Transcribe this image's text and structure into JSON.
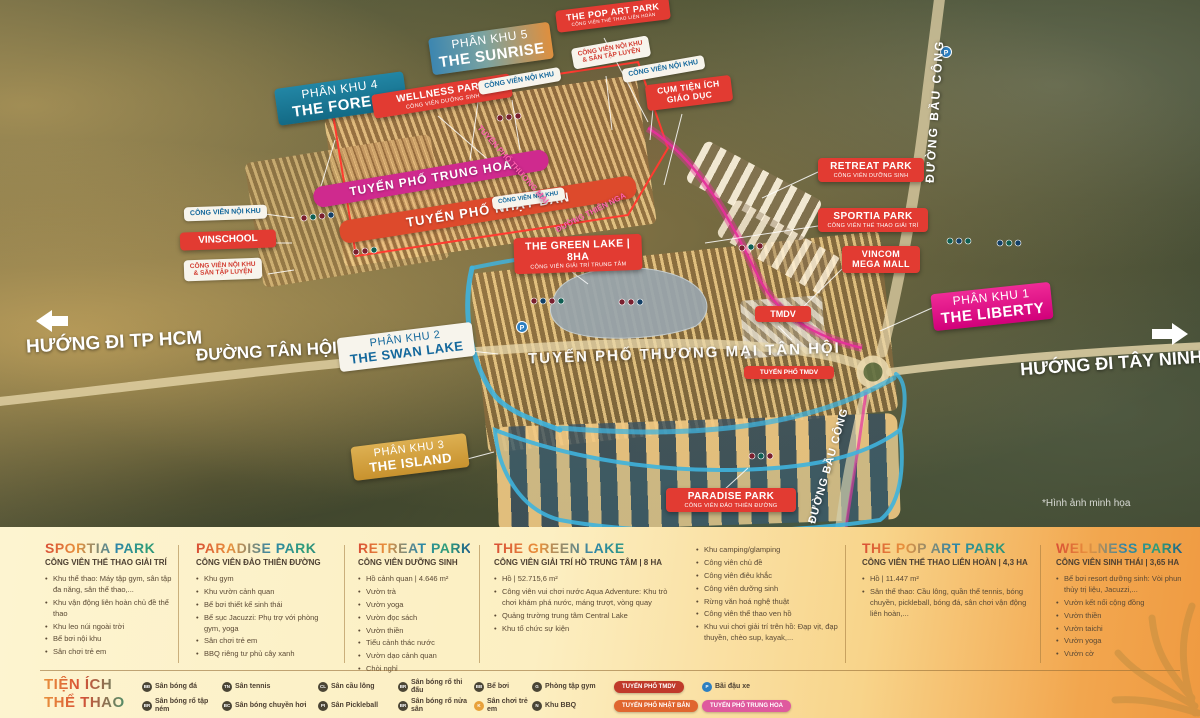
{
  "map": {
    "labels": {
      "phan_khu_4": {
        "line1": "PHÂN KHU 4",
        "line2": "THE FOREST"
      },
      "phan_khu_5": {
        "line1": "PHÂN KHU 5",
        "line2": "THE SUNRISE"
      },
      "phan_khu_1": {
        "line1": "PHÂN KHU 1",
        "line2": "THE LIBERTY"
      },
      "phan_khu_2": {
        "line1": "PHÂN KHU 2",
        "line2": "THE SWAN LAKE"
      },
      "phan_khu_3": {
        "line1": "PHÂN KHU 3",
        "line2": "THE ISLAND"
      },
      "wellness_park": {
        "line1": "WELLNESS PARK",
        "line2": "CÔNG VIÊN DƯỠNG SINH"
      },
      "pop_art_park": {
        "line1": "THE POP ART PARK",
        "line2": "CÔNG VIÊN THỂ THAO LIÊN HOÀN"
      },
      "retreat_park": {
        "line1": "RETREAT PARK",
        "line2": "CÔNG VIÊN DƯỠNG SINH"
      },
      "sportia_park": {
        "line1": "SPORTIA PARK",
        "line2": "CÔNG VIÊN THỂ THAO GIẢI TRÍ"
      },
      "vincom": {
        "line1": "VINCOM",
        "line2": "MEGA MALL"
      },
      "green_lake": {
        "line1": "THE GREEN LAKE | 8HA",
        "line2": "CÔNG VIÊN GIẢI TRÍ TRUNG TÂM"
      },
      "paradise_park": {
        "line1": "PARADISE PARK",
        "line2": "CÔNG VIÊN ĐẢO THIÊN ĐƯỜNG"
      },
      "cum_tien_ich": {
        "line1": "CỤM TIỆN ÍCH",
        "line2": "GIÁO DỤC"
      },
      "vinschool": "VINSCHOOL",
      "cv_noi_khu": "CÔNG VIÊN NỘI KHU",
      "san_tap_luyen": "& SÂN TẬP LUYỆN",
      "tmdv": "TMDV",
      "tuyen_pho_tmdv": "TUYẾN PHỐ TMDV",
      "tuyen_pho_trung_hoa": "TUYẾN PHỐ TRUNG HOA",
      "tuyen_pho_nhat_ban": "TUYẾN PHỐ NHẬT BẢN",
      "tuyen_pho_thuong_mai": "TUYẾN PHỐ THƯƠNG MẠI TÂN HỘI",
      "tuyen_pho_thuong_mai_short": "TUYẾN PHỐ THƯƠNG MẠI",
      "duong_tan_hoi": "ĐƯỜNG TÂN HỘI",
      "duong_bau_cong": "ĐƯỜNG BẦU CÔNG",
      "duong_thien_nga": "ĐƯỜNG THIÊN NGA",
      "huong_tphcm": "HƯỚNG ĐI TP HCM",
      "huong_tay_ninh": "HƯỚNG ĐI TÂY NINH",
      "parking_letter": "P",
      "watermark": "*Hình ảnh minh họa"
    }
  },
  "panel": {
    "columns": [
      {
        "title": "SPORTIA PARK",
        "subtitle": "CÔNG VIÊN THỂ THAO GIẢI TRÍ",
        "items": [
          "Khu thể thao: Máy tập gym, sân tập đa năng, sân thể thao,...",
          "Khu vận động liên hoàn chủ đề thể thao",
          "Khu leo núi ngoài trời",
          "Bể bơi nội khu",
          "Sân chơi trẻ em"
        ]
      },
      {
        "title": "PARADISE PARK",
        "subtitle": "CÔNG VIÊN ĐẢO THIÊN ĐƯỜNG",
        "items": [
          "Khu gym",
          "Khu vườn cảnh quan",
          "Bể bơi thiết kế sinh thái",
          "Bể sục Jacuzzi: Phụ trợ với phòng gym, yoga",
          "Sân chơi trẻ em",
          "BBQ riêng tư phủ cây xanh"
        ]
      },
      {
        "title": "RETREAT PARK",
        "subtitle": "CÔNG VIÊN DƯỠNG SINH",
        "items": [
          "Hồ cảnh quan | 4.646 m²",
          "Vườn trà",
          "Vườn yoga",
          "Vườn đọc sách",
          "Vườn thiền",
          "Tiểu cảnh thác nước",
          "Vườn dạo cảnh quan",
          "Chòi nghỉ"
        ]
      },
      {
        "title": "THE GREEN LAKE",
        "subtitle": "CÔNG VIÊN GIẢI TRÍ HỒ TRUNG TÂM | 8 HA",
        "items": [
          "Hồ | 52.715,6 m²",
          "Công viên vui chơi nước Aqua Adventure: Khu trò chơi khám phá nước, máng trượt, vòng quay",
          "Quảng trường trung tâm Central Lake",
          "Khu tổ chức sự kiện"
        ]
      },
      {
        "title": "",
        "subtitle": "",
        "items": [
          "Khu camping/glamping",
          "Công viên chủ đề",
          "Công viên điêu khắc",
          "Công viên dưỡng sinh",
          "Rừng văn hoá nghệ thuật",
          "Công viên thể thao ven hồ",
          "Khu vui chơi giải trí trên hồ: Đạp vịt, đạp thuyền, chèo sup, kayak,..."
        ]
      },
      {
        "title": "THE POP ART PARK",
        "subtitle": "CÔNG VIÊN THỂ THAO LIÊN HOÀN | 4,3 HA",
        "items": [
          "Hồ | 11.447 m²",
          "Sân thể thao: Cầu lông, quần thể tennis, bóng chuyền, pickleball, bóng đá, sân chơi vận động liên hoàn,..."
        ]
      },
      {
        "title": "WELLNESS PARK",
        "subtitle": "CÔNG VIÊN SINH THÁI | 3,65 HA",
        "items": [
          "Bể bơi resort dưỡng sinh: Vòi phun thủy trị liệu, Jacuzzi,...",
          "Vườn kết nối cộng đồng",
          "Vườn thiền",
          "Vườn taichi",
          "Vườn yoga",
          "Vườn cờ"
        ]
      }
    ]
  },
  "legend": {
    "title_line1": "TIỆN ÍCH",
    "title_line2": "THỂ THAO",
    "row1": [
      {
        "badge": "BĐ",
        "label": "Sân bóng đá"
      },
      {
        "badge": "TN",
        "label": "Sân tennis"
      },
      {
        "badge": "CL",
        "label": "Sân cầu lông"
      },
      {
        "badge": "BR",
        "label": "Sân bóng rổ thi đấu"
      },
      {
        "badge": "BB",
        "label": "Bể bơi"
      },
      {
        "badge": "G",
        "label": "Phòng tập gym"
      },
      {
        "badge": "P",
        "label": "Bãi đậu xe"
      }
    ],
    "row2": [
      {
        "badge": "BR",
        "label": "Sân bóng rổ tập ném"
      },
      {
        "badge": "BC",
        "label": "Sân bóng chuyền hơi"
      },
      {
        "badge": "PI",
        "label": "Sân Pickleball"
      },
      {
        "badge": "BR",
        "label": "Sân bóng rổ nửa sân"
      },
      {
        "badge": "K",
        "label": "Sân chơi trẻ em"
      },
      {
        "badge": "N",
        "label": "Khu BBQ"
      }
    ]
  },
  "colors": {
    "label_red": "#e23b32",
    "zone_teal": "#1d7f9c",
    "zone_magenta": "#e5168c",
    "zone_gold": "#d2a040",
    "band_trung_hoa": "#cf2a8e",
    "band_nhat_ban": "#dd4a2c",
    "canal_blue": "#3fb3dd",
    "boundary_pink": "#e5309a",
    "boundary_red": "#ff3b30",
    "white_label_blue_text": "#14689c",
    "pill_tmdv": "#c03a2b",
    "pill_nhat_ban": "#e0662f",
    "pill_trung_hoa": "#df5a9e",
    "parking_blue": "#2d7fc1",
    "kids_orange": "#e8a13a"
  }
}
